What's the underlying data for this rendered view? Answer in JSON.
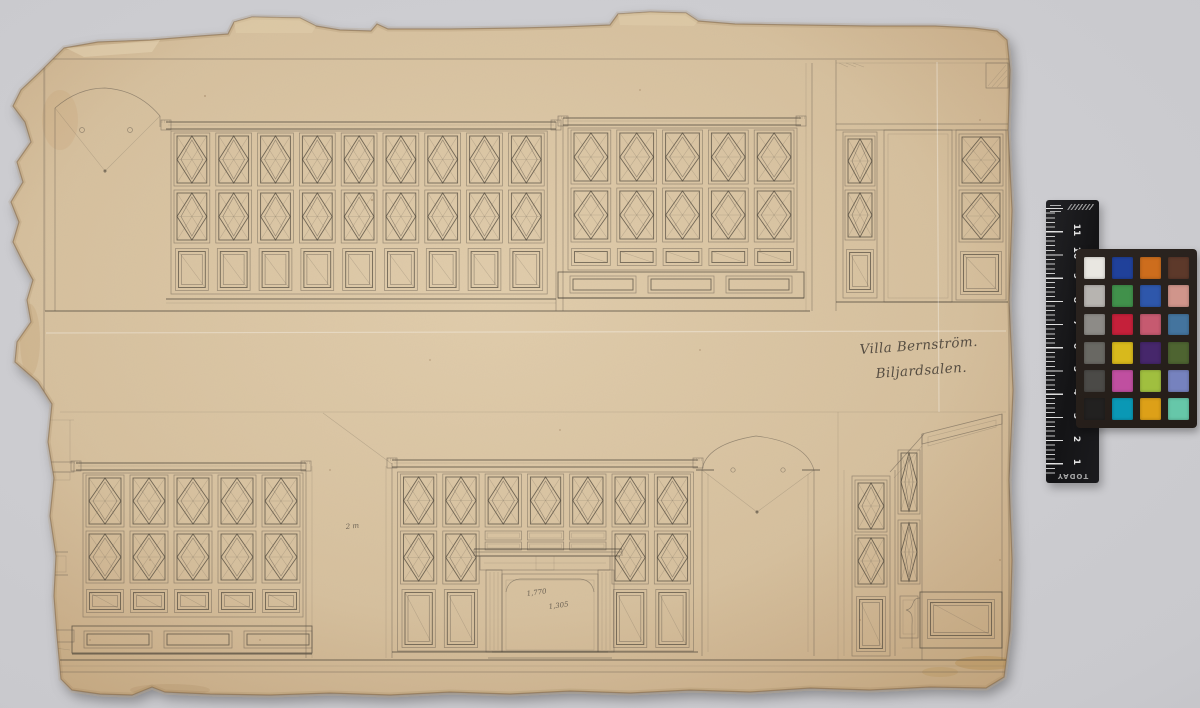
{
  "photo": {
    "backdrop_color": "#d2d2d6",
    "description": "Archival photograph of an architectural pencil drawing (panelled wall elevations of a billiard room) on aged torn paper, with a photographic ruler and a 24-patch colour calibration chart"
  },
  "paper": {
    "tone_light": "#e1cdac",
    "tone_mid": "#d6c09e",
    "tone_edge": "#c2a47d"
  },
  "handwriting": {
    "line1": "Villa Bernström.",
    "line2": "Biljardsalen."
  },
  "dimensions": {
    "fireplace_width": "1,770",
    "fireplace_height": "1,305",
    "wall_note": "2 m"
  },
  "drawing": {
    "subject": "Wall elevations with diamond-pattern panelling",
    "top_elevation": {
      "left_wall_panels": 9,
      "middle_wall_panels": 5,
      "diamond_rows": 2,
      "has_arch": true,
      "has_door": true
    },
    "bottom_elevation": {
      "left_wall_panels": 5,
      "middle_wall_panels": 7,
      "has_fireplace": true,
      "has_arch": true
    }
  },
  "ruler": {
    "numbers": [
      "11",
      "10",
      "9",
      "8",
      "7",
      "6",
      "5",
      "4",
      "3",
      "2",
      "1"
    ],
    "bottom_label": "TODAY",
    "body_color": "#161618"
  },
  "color_checker": {
    "frame_color": "#241d18",
    "rows": 6,
    "cols": 4,
    "patches": [
      {
        "name": "white",
        "hex": "#e9e7e1"
      },
      {
        "name": "blue",
        "hex": "#20419a"
      },
      {
        "name": "orange",
        "hex": "#cd6d1d"
      },
      {
        "name": "dark-skin",
        "hex": "#5d392a"
      },
      {
        "name": "neutral-8",
        "hex": "#b7b4b0"
      },
      {
        "name": "green",
        "hex": "#41914b"
      },
      {
        "name": "purplish-blue",
        "hex": "#2e57ab"
      },
      {
        "name": "light-skin",
        "hex": "#d0958b"
      },
      {
        "name": "neutral-6.5",
        "hex": "#8d8b87"
      },
      {
        "name": "red",
        "hex": "#c5203a"
      },
      {
        "name": "moderate-red",
        "hex": "#c65a70"
      },
      {
        "name": "blue-sky",
        "hex": "#44749e"
      },
      {
        "name": "neutral-5",
        "hex": "#696863"
      },
      {
        "name": "yellow",
        "hex": "#d8b91c"
      },
      {
        "name": "purple",
        "hex": "#46276b"
      },
      {
        "name": "foliage",
        "hex": "#4e6431"
      },
      {
        "name": "neutral-3.5",
        "hex": "#4b4a47"
      },
      {
        "name": "magenta",
        "hex": "#c04fa0"
      },
      {
        "name": "yellow-green",
        "hex": "#a0bf3f"
      },
      {
        "name": "blue-flower",
        "hex": "#7682be"
      },
      {
        "name": "black",
        "hex": "#222120"
      },
      {
        "name": "cyan",
        "hex": "#0a98b5"
      },
      {
        "name": "orange-yellow",
        "hex": "#dda018"
      },
      {
        "name": "bluish-green",
        "hex": "#66c7a9"
      }
    ]
  }
}
